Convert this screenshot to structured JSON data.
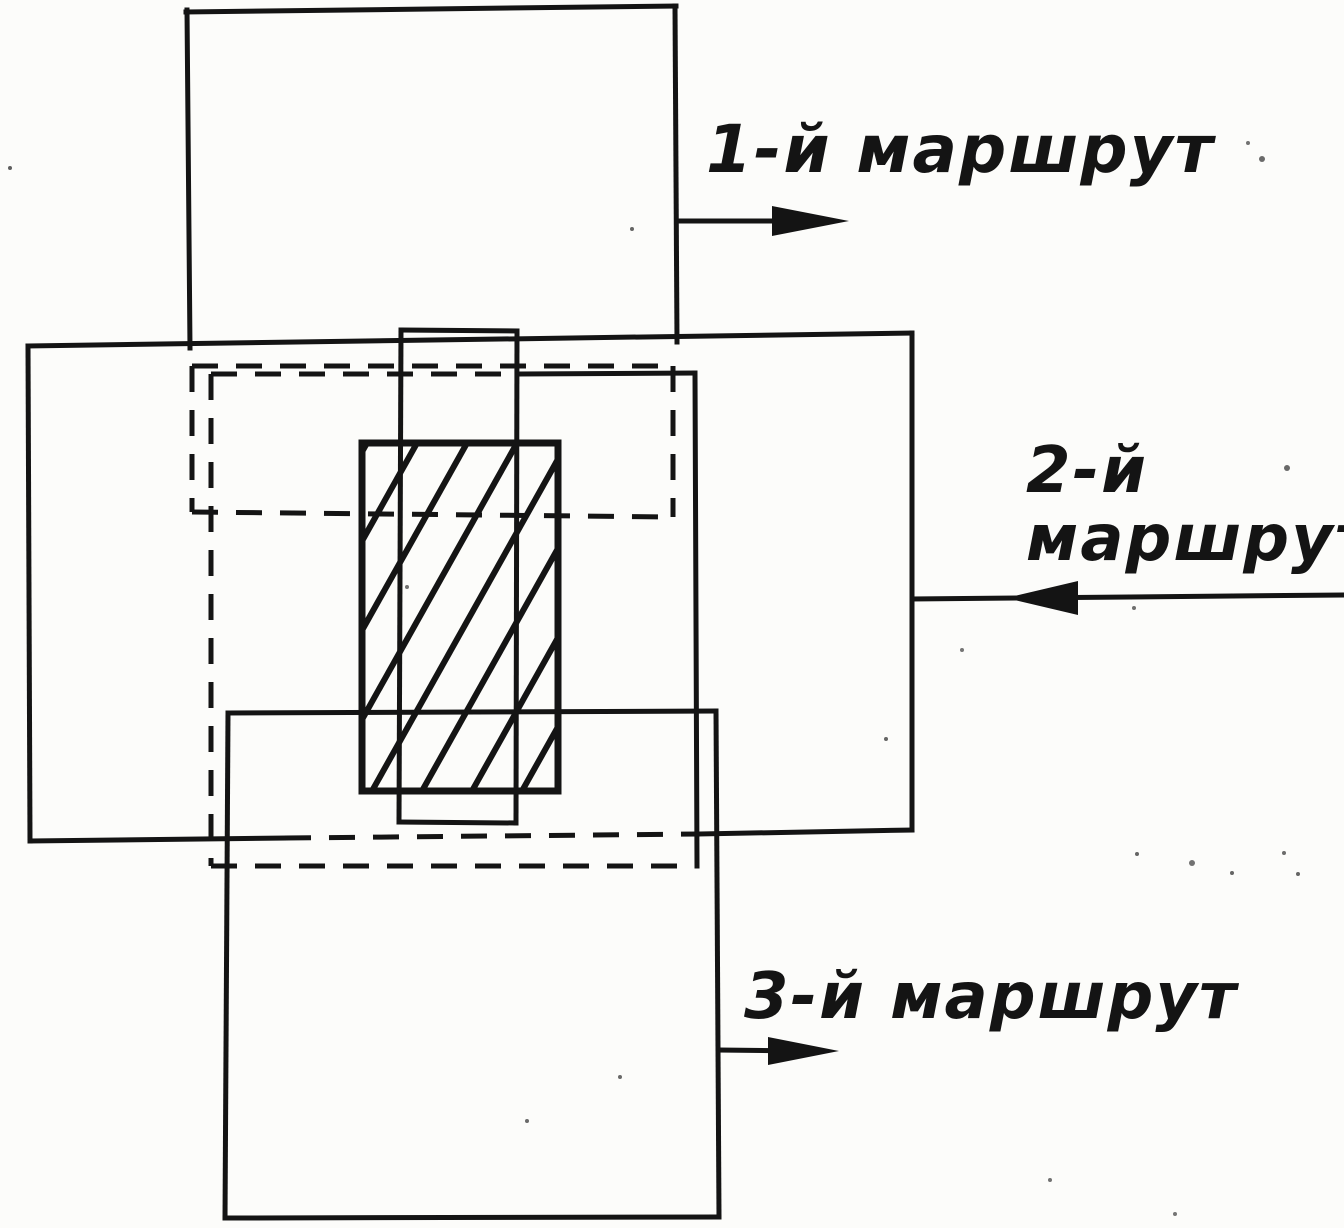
{
  "figure_title": "Схема перекрытия аэрофотоснимков трёх маршрутов",
  "diagram": {
    "canvas": {
      "w": 1344,
      "h": 1228
    },
    "ink": "#141414",
    "paper": "#fcfcfa",
    "stroke_width": 5,
    "solid_lines": [
      [
        186,
        12,
        676,
        6
      ],
      [
        187,
        10,
        190,
        348
      ],
      [
        675,
        6,
        677,
        342
      ],
      [
        28,
        346,
        912,
        333
      ],
      [
        28,
        346,
        30,
        841
      ],
      [
        912,
        333,
        912,
        830
      ],
      [
        30,
        841,
        285,
        838
      ],
      [
        700,
        834,
        912,
        830
      ],
      [
        228,
        713,
        716,
        711
      ],
      [
        228,
        713,
        225,
        1218
      ],
      [
        716,
        711,
        719,
        1217
      ],
      [
        225,
        1218,
        719,
        1217
      ],
      [
        401,
        330,
        517,
        331
      ],
      [
        401,
        330,
        399,
        822
      ],
      [
        517,
        331,
        516,
        823
      ],
      [
        399,
        822,
        516,
        823
      ],
      [
        521,
        374,
        695,
        373
      ],
      [
        695,
        373,
        697,
        866
      ]
    ],
    "dashed_lines": [
      [
        192,
        366,
        673,
        366
      ],
      [
        192,
        366,
        192,
        512
      ],
      [
        673,
        366,
        673,
        517
      ],
      [
        192,
        512,
        673,
        517
      ],
      [
        211,
        374,
        521,
        374
      ],
      [
        211,
        374,
        211,
        866
      ],
      [
        211,
        866,
        697,
        866
      ],
      [
        285,
        838,
        700,
        834
      ]
    ],
    "dash_pattern": "26 18",
    "hatch": {
      "x": 362,
      "y": 443,
      "w": 196,
      "h": 348,
      "border_width": 7,
      "line_width": 6,
      "spacing": 50,
      "run": 195,
      "start_offset": -190
    },
    "arrows": [
      {
        "name": "route-1-arrow",
        "line": [
          677,
          221,
          790,
          221
        ],
        "tip": [
          849,
          221
        ],
        "base_x": 772,
        "half": 15
      },
      {
        "name": "route-2-arrow",
        "line": [
          1344,
          595,
          913,
          599
        ],
        "tip": [
          1006,
          598
        ],
        "base_x": 1078,
        "half": 17
      },
      {
        "name": "route-3-arrow",
        "line": [
          719,
          1050,
          800,
          1051
        ],
        "tip": [
          839,
          1051
        ],
        "base_x": 768,
        "half": 14
      }
    ],
    "labels": {
      "route1": {
        "text": "1-й маршрут",
        "x": 706,
        "y": 172,
        "size": 66
      },
      "route2_line1": {
        "text": "2-й",
        "x": 1026,
        "y": 492,
        "size": 64
      },
      "route2_line2": {
        "text": "маршрут",
        "x": 1026,
        "y": 560,
        "size": 64
      },
      "route3": {
        "text": "3-й маршрут",
        "x": 744,
        "y": 1018,
        "size": 64
      }
    }
  }
}
